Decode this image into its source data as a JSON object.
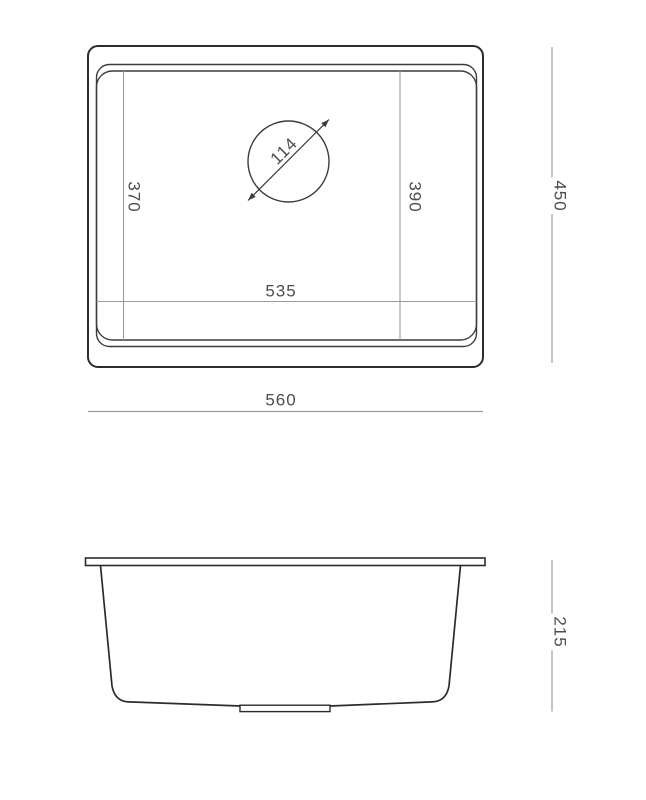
{
  "top_view": {
    "drain_diameter": "114",
    "bowl_depth_left": "370",
    "bowl_depth_right": "390",
    "bowl_width": "535",
    "overall_width": "560",
    "overall_depth": "450"
  },
  "side_view": {
    "overall_height": "215"
  },
  "colors": {
    "outline": "#2c2c2c",
    "rim_line": "#3c3c3c",
    "dimension_line": "#9c9c9c",
    "label_text": "#4d4d4d",
    "background": "#ffffff"
  }
}
